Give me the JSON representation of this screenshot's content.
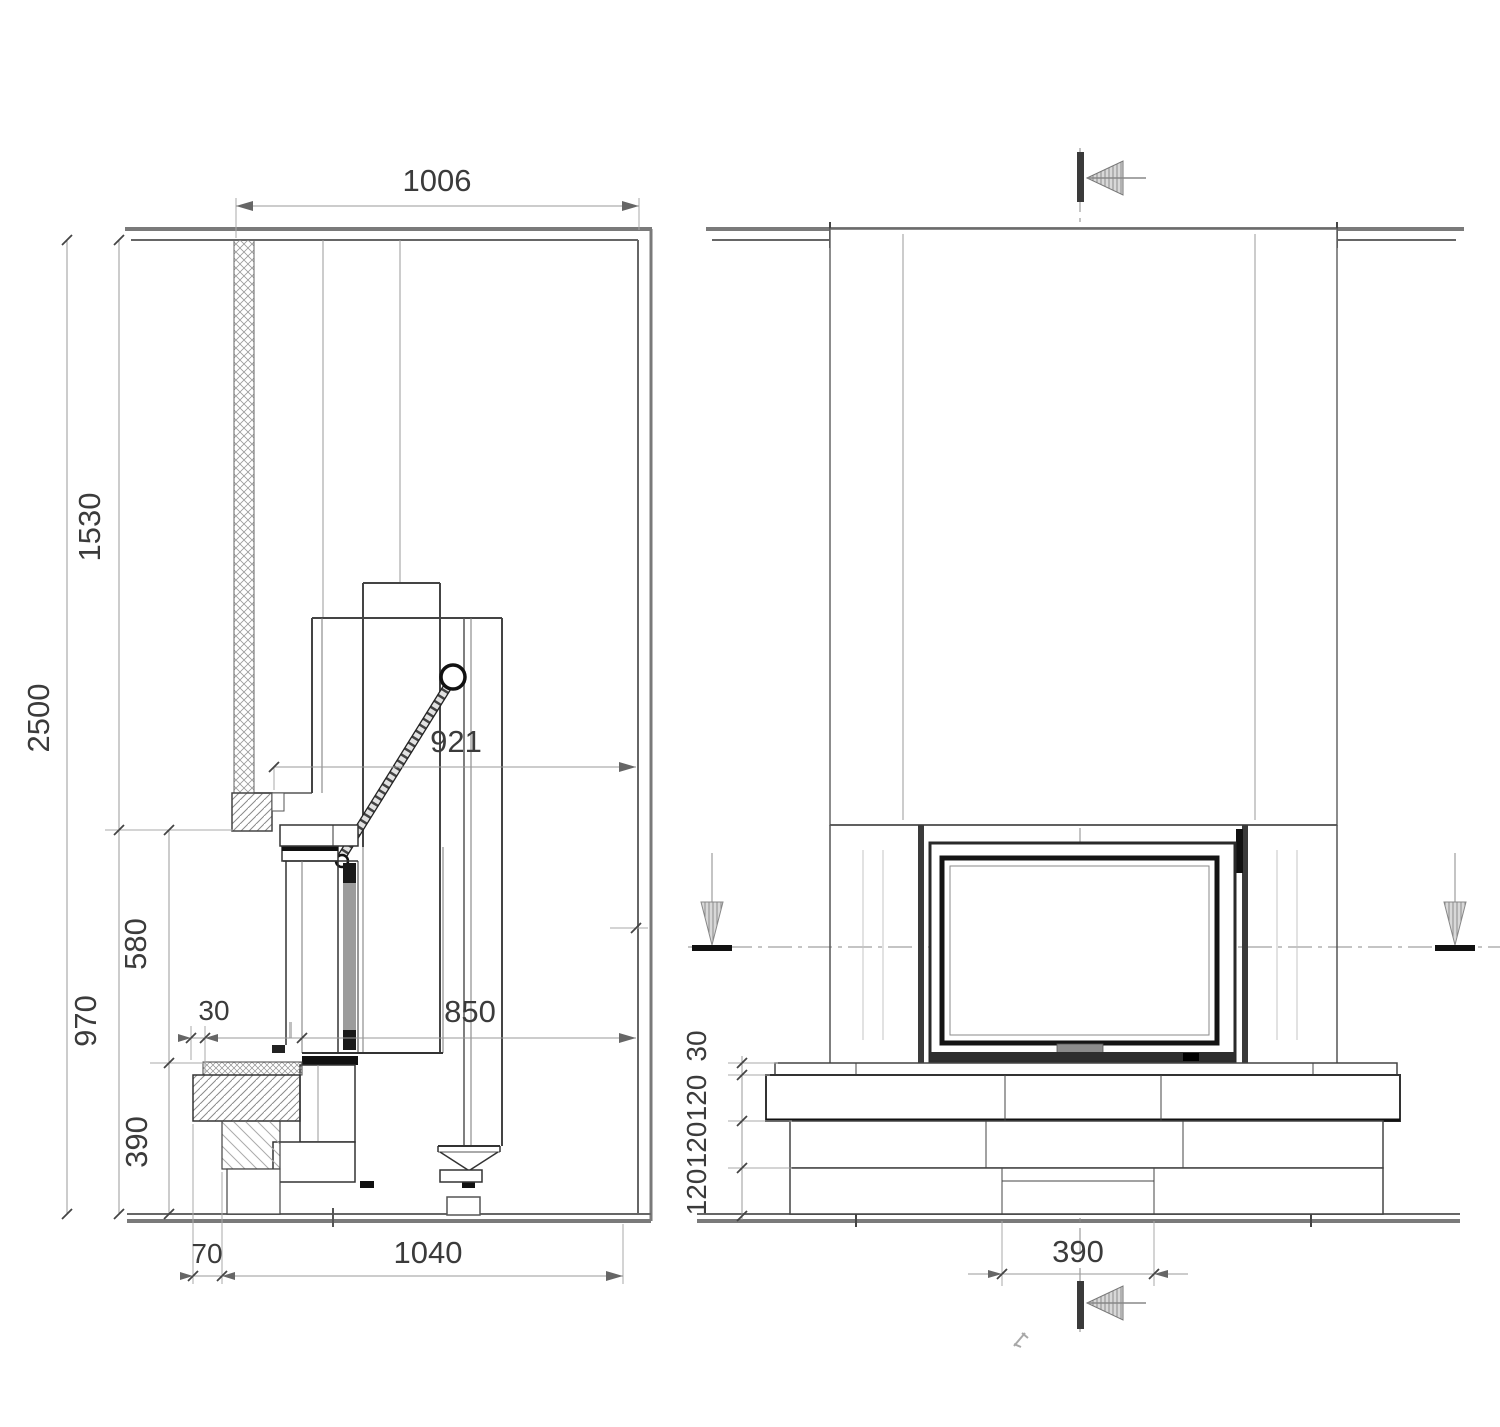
{
  "views": {
    "side": {
      "dims": {
        "top_width": "1006",
        "total_height": "2500",
        "upper_height": "1530",
        "lower_height": "970",
        "firebox_height": "580",
        "hearth_offset": "30",
        "top_depth": "921",
        "insert_depth": "850",
        "base_height": "390",
        "plinth_offset": "70",
        "total_depth": "1040"
      }
    },
    "front": {
      "dims": {
        "hearth_thickness": "30",
        "course_1": "120",
        "course_2": "120",
        "course_3": "120",
        "base_width": "390"
      }
    },
    "colors": {
      "line_dark": "#333333",
      "line_gray": "#888888",
      "fill_dark": "#1a1a1a",
      "glass_gray": "#999999"
    }
  }
}
